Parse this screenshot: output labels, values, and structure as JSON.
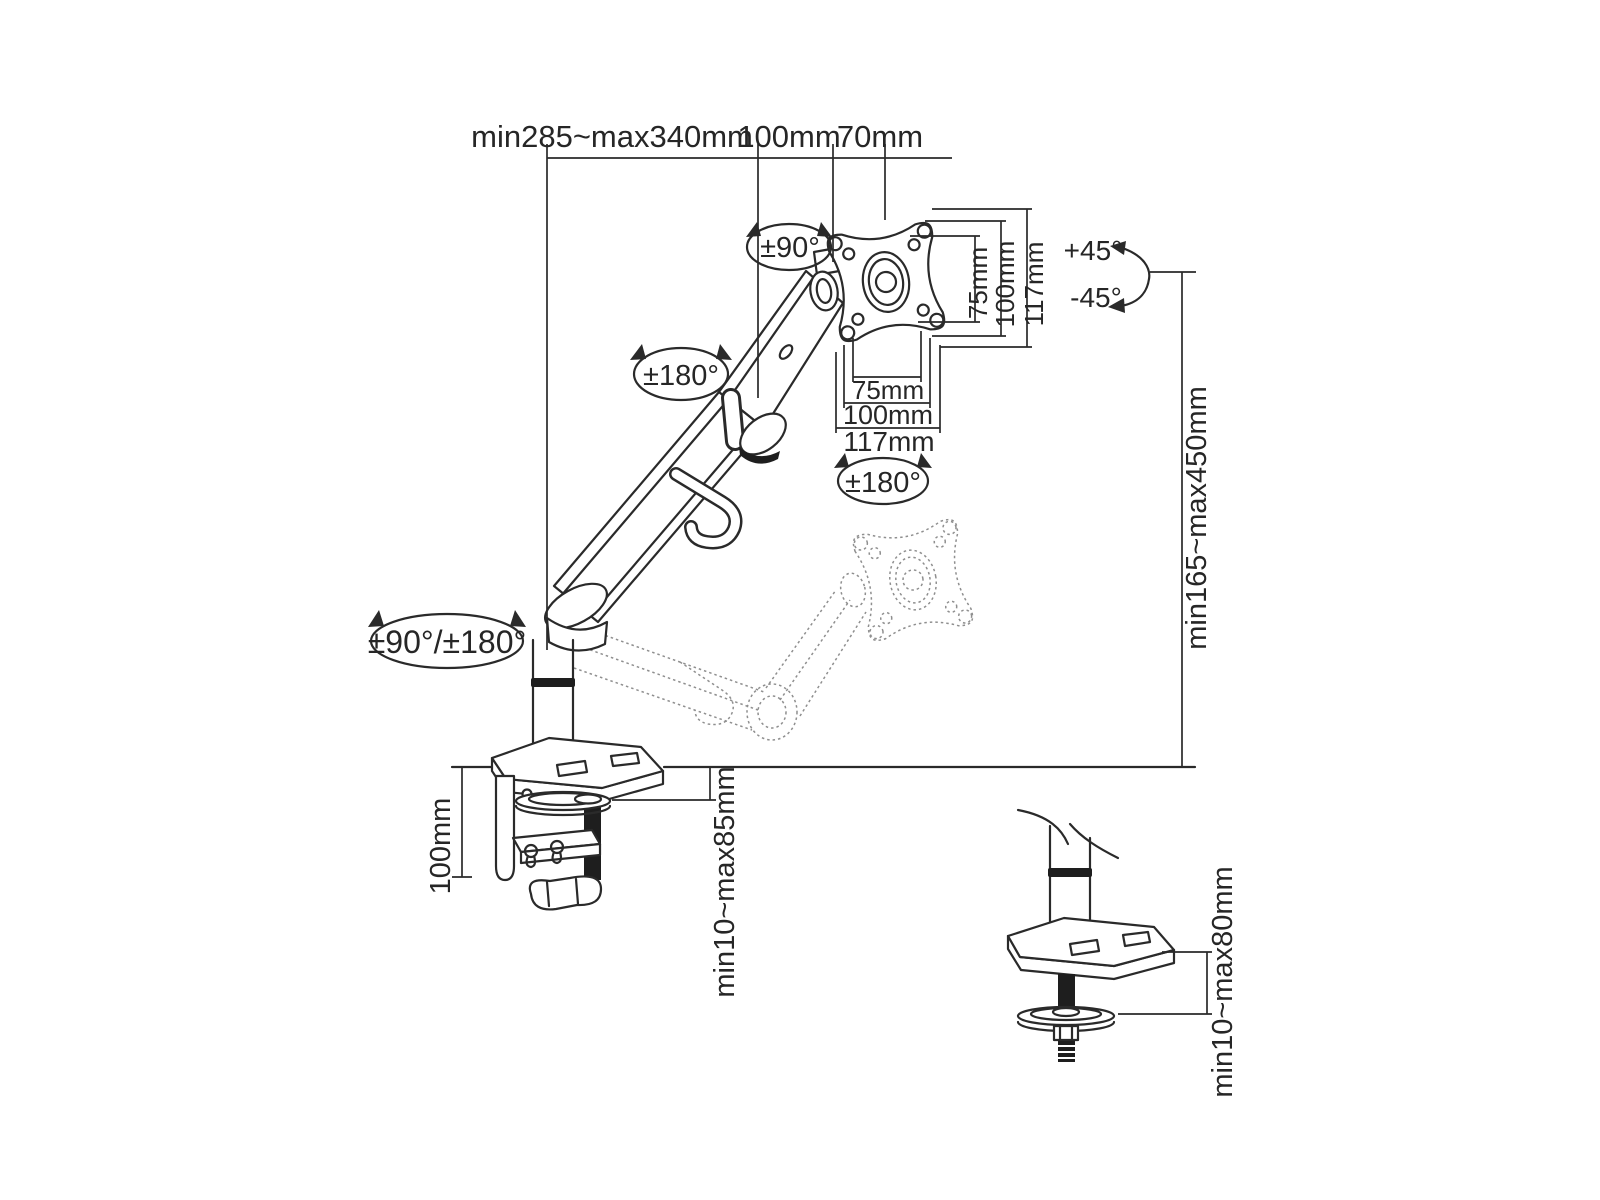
{
  "figure": {
    "background": "#ffffff",
    "line_color": "#2a2a2a",
    "ghost_line_color": "#8f8f8f"
  },
  "dimensions": {
    "top_span": "min285~max340mm",
    "top_offset": "100mm",
    "top_plate": "70mm",
    "vesa_vertical": [
      "75mm",
      "100mm",
      "117mm"
    ],
    "vesa_horizontal": [
      "75mm",
      "100mm",
      "117mm"
    ],
    "height_range": "min165~max450mm",
    "clamp_height": "100mm",
    "clamp_thickness": "min10~max85mm",
    "grommet_thickness": "min10~max80mm"
  },
  "rotations": {
    "head_swivel": "±90°",
    "arm_rotation": "±180°",
    "plate_rotation": "±180°",
    "base_rotation": "±90°/±180°",
    "tilt_up": "+45°",
    "tilt_down": "-45°"
  }
}
